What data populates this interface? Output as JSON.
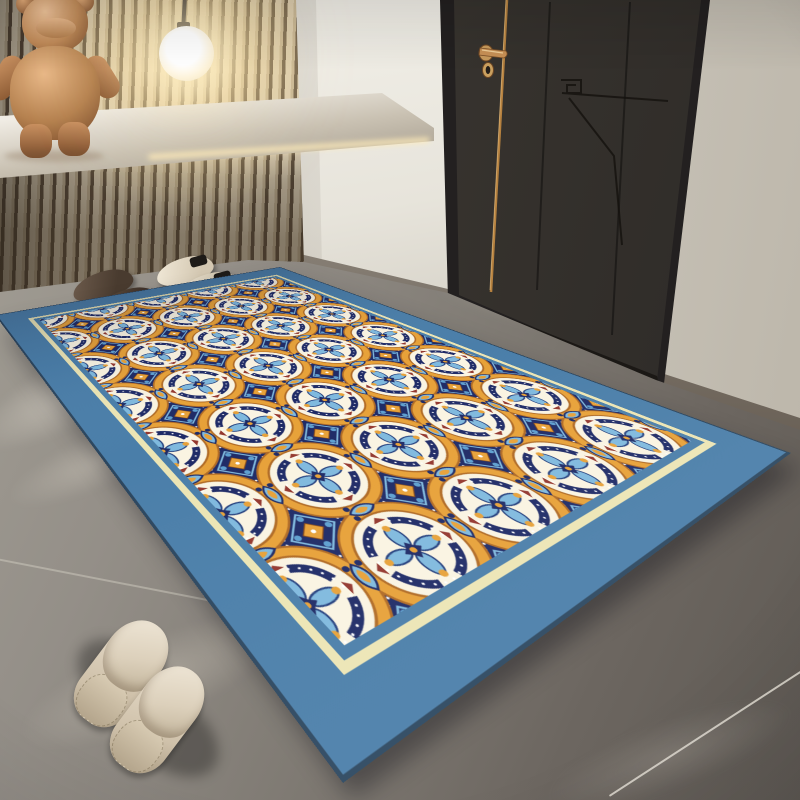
{
  "scene": {
    "description": "Entryway interior product photo: blue-bordered Moroccan trellis area rug on gray tile floor beside a dark charcoal door, wood-slat accent wall with floating shelf, copper bear figurine and glowing pendant globe lamp; two pairs of shoes by the wall and beige slippers in the foreground",
    "objects": [
      {
        "name": "area-rug",
        "label": "moroccan trellis rug with steel-blue border"
      },
      {
        "name": "wood-slat-accent-wall",
        "label": "vertical wood slat panel"
      },
      {
        "name": "floating-shelf",
        "label": "white stone floating shelf"
      },
      {
        "name": "copper-bear-figurine",
        "label": "copper bear sculpture"
      },
      {
        "name": "pendant-globe-lamp",
        "label": "glowing white globe pendant"
      },
      {
        "name": "entry-door",
        "label": "charcoal door with copper trim and handle"
      },
      {
        "name": "brown-leather-shoes",
        "label": "dark brown pair of shoes"
      },
      {
        "name": "cream-slip-on-shoes",
        "label": "cream shoes with black straps"
      },
      {
        "name": "beige-slippers",
        "label": "beige mule slippers"
      },
      {
        "name": "gray-tile-floor",
        "label": "large-format gray tiles with seams"
      }
    ]
  },
  "colors": {
    "rugBorder": "#4a7ea9",
    "rugField": "#f5eeda",
    "rugInnerLine": "#ece5b4",
    "patternNavy": "#1e2a66",
    "patternOrange": "#e7a138",
    "patternOrangeDark": "#b06a24",
    "patternBlue": "#7fb9de",
    "patternBlueDeep": "#5d9fd0",
    "patternRed": "#93372e",
    "door": "#38342f",
    "doorFrame": "#232020",
    "copper": "#c2915e",
    "slatLight": "#d4c8b1",
    "slatDark": "#57493a",
    "wallWhite": "#f4f2eb",
    "wallRight": "#d5d0c6",
    "floorLight": "#a8a399",
    "floorDark": "#5e5953",
    "lampGlow": "#ffeec2",
    "statueCopper": "#c08a58",
    "slipperBeige": "#e0d5c2",
    "shoeCream": "#eee6d6",
    "shoeBrown": "#4a3c31"
  }
}
